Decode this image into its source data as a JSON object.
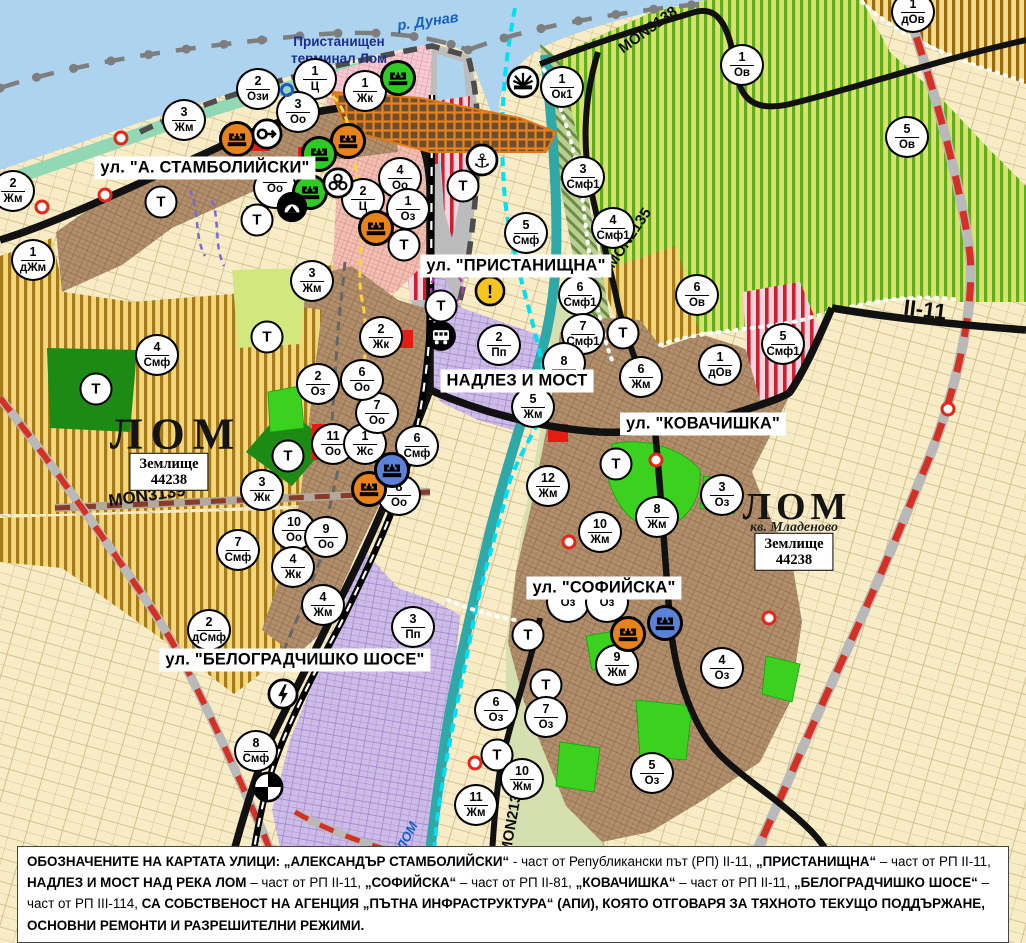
{
  "map": {
    "title_labels": {
      "river": "р. Дунав",
      "river_lom": "ЛОМ",
      "port_terminal_line1": "Пристанищен",
      "port_terminal_line2": "терминал Лом",
      "city_west": "ЛОМ",
      "city_east": "ЛОМ",
      "district_east": "кв. Младеново",
      "landplot_label": "Землище",
      "landplot_code": "44238"
    },
    "street_labels": [
      {
        "id": "stamboliyski",
        "x": 205,
        "y": 168,
        "text": "ул. \"А. СТАМБОЛИЙСКИ\""
      },
      {
        "id": "pristanishtna",
        "x": 516,
        "y": 266,
        "text": "ул. \"ПРИСТАНИЩНА\""
      },
      {
        "id": "nadlez-i-most",
        "x": 517,
        "y": 381,
        "text": "НАДЛЕЗ И МОСТ"
      },
      {
        "id": "kovachishka",
        "x": 703,
        "y": 424,
        "text": "ул. \"КОВАЧИШКА\""
      },
      {
        "id": "sofiyska",
        "x": 604,
        "y": 588,
        "text": "ул. \"СОФИЙСКА\""
      },
      {
        "id": "belogradchishko-shose",
        "x": 295,
        "y": 660,
        "text": "ул. \"БЕЛОГРАДЧИШКО ШОСЕ\""
      }
    ],
    "road_labels": [
      {
        "id": "mon3139",
        "text": "MON3139",
        "x": 147,
        "y": 496,
        "rot": -8,
        "size": 17
      },
      {
        "id": "mon3138",
        "text": "MON3138",
        "x": 648,
        "y": 30,
        "rot": -36,
        "size": 15
      },
      {
        "id": "mon2135",
        "text": "MON2135",
        "x": 629,
        "y": 238,
        "rot": -56,
        "size": 15
      },
      {
        "id": "mon2136",
        "text": "MON2136",
        "x": 512,
        "y": 820,
        "rot": -80,
        "size": 15
      },
      {
        "id": "ii-11",
        "text": "II-11",
        "x": 925,
        "y": 310,
        "rot": 7,
        "size": 22
      }
    ],
    "zone_markers": [
      [
        258,
        89,
        "2",
        "Ози"
      ],
      [
        315,
        79,
        "1",
        "Ц"
      ],
      [
        365,
        91,
        "1",
        "Жк"
      ],
      [
        184,
        120,
        "3",
        "Жм"
      ],
      [
        298,
        112,
        "3",
        "Оо"
      ],
      [
        13,
        191,
        "2",
        "Жм"
      ],
      [
        33,
        260,
        "1",
        "дЖм"
      ],
      [
        400,
        178,
        "4",
        "Оо"
      ],
      [
        363,
        199,
        "2",
        "Ц"
      ],
      [
        408,
        209,
        "1",
        "Оз"
      ],
      [
        312,
        281,
        "3",
        "Жм"
      ],
      [
        275,
        188,
        "",
        "Оо"
      ],
      [
        157,
        355,
        "4",
        "Смф"
      ],
      [
        262,
        490,
        "3",
        "Жк"
      ],
      [
        294,
        530,
        "10",
        "Оо"
      ],
      [
        326,
        537,
        "9",
        "Оо"
      ],
      [
        238,
        550,
        "7",
        "Смф"
      ],
      [
        293,
        567,
        "4",
        "Жк"
      ],
      [
        323,
        605,
        "4",
        "Жм"
      ],
      [
        209,
        630,
        "2",
        "дСмф"
      ],
      [
        333,
        444,
        "11",
        "Оо"
      ],
      [
        365,
        444,
        "1",
        "Жс"
      ],
      [
        377,
        413,
        "7",
        "Оо"
      ],
      [
        399,
        495,
        "8",
        "Оо"
      ],
      [
        318,
        384,
        "2",
        "Оз"
      ],
      [
        381,
        337,
        "2",
        "Жк"
      ],
      [
        362,
        380,
        "6",
        "Оо"
      ],
      [
        417,
        446,
        "6",
        "Смф"
      ],
      [
        562,
        87,
        "1",
        "Ок1"
      ],
      [
        583,
        177,
        "3",
        "Смф1"
      ],
      [
        613,
        228,
        "4",
        "Смф1"
      ],
      [
        526,
        233,
        "5",
        "Смф"
      ],
      [
        580,
        295,
        "6",
        "Смф1"
      ],
      [
        583,
        334,
        "7",
        "Смф1"
      ],
      [
        499,
        345,
        "2",
        "Пп"
      ],
      [
        533,
        407,
        "5",
        "Жм"
      ],
      [
        564,
        363,
        "8",
        ""
      ],
      [
        641,
        377,
        "6",
        "Жм"
      ],
      [
        697,
        295,
        "6",
        "Ов"
      ],
      [
        720,
        365,
        "1",
        "дОв"
      ],
      [
        783,
        344,
        "5",
        "Смф1"
      ],
      [
        742,
        65,
        "1",
        "Ов"
      ],
      [
        907,
        137,
        "5",
        "Ов"
      ],
      [
        913,
        12,
        "1",
        "дОв"
      ],
      [
        722,
        495,
        "3",
        "Оз"
      ],
      [
        657,
        517,
        "8",
        "Жм"
      ],
      [
        548,
        486,
        "12",
        "Жм"
      ],
      [
        600,
        532,
        "10",
        "Жм"
      ],
      [
        617,
        665,
        "9",
        "Жм"
      ],
      [
        722,
        668,
        "4",
        "Оз"
      ],
      [
        568,
        602,
        "",
        "Оз"
      ],
      [
        607,
        602,
        "",
        "Оз"
      ],
      [
        496,
        710,
        "6",
        "Оз"
      ],
      [
        546,
        717,
        "7",
        "Оз"
      ],
      [
        522,
        779,
        "10",
        "Жм"
      ],
      [
        476,
        805,
        "11",
        "Жм"
      ],
      [
        652,
        773,
        "5",
        "Оз"
      ],
      [
        413,
        627,
        "3",
        "Пп"
      ],
      [
        256,
        751,
        "8",
        "Смф"
      ]
    ],
    "terrain_marker_label": "Т",
    "terrain_markers": [
      [
        161,
        202
      ],
      [
        257,
        220
      ],
      [
        404,
        245
      ],
      [
        96,
        389
      ],
      [
        267,
        337
      ],
      [
        288,
        456
      ],
      [
        463,
        186
      ],
      [
        441,
        306
      ],
      [
        623,
        333
      ],
      [
        616,
        464
      ],
      [
        528,
        635
      ],
      [
        546,
        685
      ],
      [
        497,
        755
      ]
    ],
    "poi_markers": [
      {
        "x": 237,
        "y": 139,
        "type": "heritage-orange"
      },
      {
        "x": 348,
        "y": 141,
        "type": "heritage-orange"
      },
      {
        "x": 376,
        "y": 228,
        "type": "heritage-orange"
      },
      {
        "x": 369,
        "y": 489,
        "type": "heritage-orange"
      },
      {
        "x": 628,
        "y": 634,
        "type": "heritage-orange"
      },
      {
        "x": 398,
        "y": 78,
        "type": "heritage-green"
      },
      {
        "x": 319,
        "y": 154,
        "type": "heritage-green"
      },
      {
        "x": 310,
        "y": 192,
        "type": "heritage-green"
      },
      {
        "x": 392,
        "y": 470,
        "type": "heritage-blue"
      },
      {
        "x": 665,
        "y": 623,
        "type": "heritage-blue"
      },
      {
        "x": 267,
        "y": 134,
        "type": "key"
      },
      {
        "x": 338,
        "y": 183,
        "type": "trefoil"
      },
      {
        "x": 292,
        "y": 207,
        "type": "tunnel"
      },
      {
        "x": 482,
        "y": 160,
        "type": "anchor"
      },
      {
        "x": 523,
        "y": 82,
        "type": "beacon"
      },
      {
        "x": 490,
        "y": 291,
        "type": "warning"
      },
      {
        "x": 441,
        "y": 336,
        "type": "bus"
      },
      {
        "x": 283,
        "y": 694,
        "type": "power"
      },
      {
        "x": 268,
        "y": 787,
        "type": "railcross"
      },
      {
        "x": 287,
        "y": 90,
        "type": "bluering"
      }
    ],
    "red_dots": [
      [
        121,
        138
      ],
      [
        105,
        195
      ],
      [
        42,
        207
      ],
      [
        569,
        542
      ],
      [
        656,
        460
      ],
      [
        769,
        618
      ],
      [
        948,
        409
      ],
      [
        475,
        763
      ]
    ],
    "river_lom_label": {
      "x": 407,
      "y": 836,
      "rot": -62,
      "size": 13
    },
    "danube_label": {
      "x": 428,
      "y": 22,
      "rot": -8,
      "size": 14.5
    }
  },
  "footer": {
    "segments": [
      {
        "t": "ОБОЗНАЧЕНИТЕ НА КАРТАТА УЛИЦИ: „АЛЕКСАНДЪР СТАМБОЛИЙСКИ“",
        "b": true
      },
      {
        "t": " - част от Републикански път (РП) II-11, ",
        "b": false
      },
      {
        "t": "„ПРИСТАНИЩНА“",
        "b": true
      },
      {
        "t": " – част от РП II-11, ",
        "b": false
      },
      {
        "t": "НАДЛЕЗ И МОСТ НАД РЕКА ЛОМ",
        "b": true
      },
      {
        "t": " – част от РП II-11, ",
        "b": false
      },
      {
        "t": "„СОФИЙСКА“",
        "b": true
      },
      {
        "t": " – част от РП II-81, ",
        "b": false
      },
      {
        "t": "„КОВАЧИШКА“",
        "b": true
      },
      {
        "t": " – част от РП II-11, ",
        "b": false
      },
      {
        "t": "„БЕЛОГРАДЧИШКО ШОСЕ“",
        "b": true
      },
      {
        "t": " – част от РП III-114, ",
        "b": false
      },
      {
        "t": "СА СОБСТВЕНОСТ НА АГЕНЦИЯ „ПЪТНА ИНФРАСТРУКТУРА“ (АПИ), КОЯТО ОТГОВАРЯ ЗА ТЯХНОТО ТЕКУЩО ПОДДЪРЖАНЕ, ОСНОВНИ РЕМОНТИ И РАЗРЕШИТЕЛНИ РЕЖИМИ.",
        "b": true
      }
    ]
  },
  "colors": {
    "water": "#aed3ee",
    "shore": "#92d8b4",
    "urban_brown": "#b18f6d",
    "lavender": "#cdbbe8",
    "beige": "#f8ecc6",
    "park_green": "#3cd11f",
    "forest_green": "#1c8a14",
    "red_zone": "#e51c12",
    "road_black": "#111111",
    "dashed_red": "#d43024",
    "cyan_channel": "#00e0f2",
    "heritage_orange": "#e8821c",
    "heritage_green": "#2ecb25",
    "heritage_blue": "#5b82d8",
    "warning_yellow": "#f4c520"
  }
}
